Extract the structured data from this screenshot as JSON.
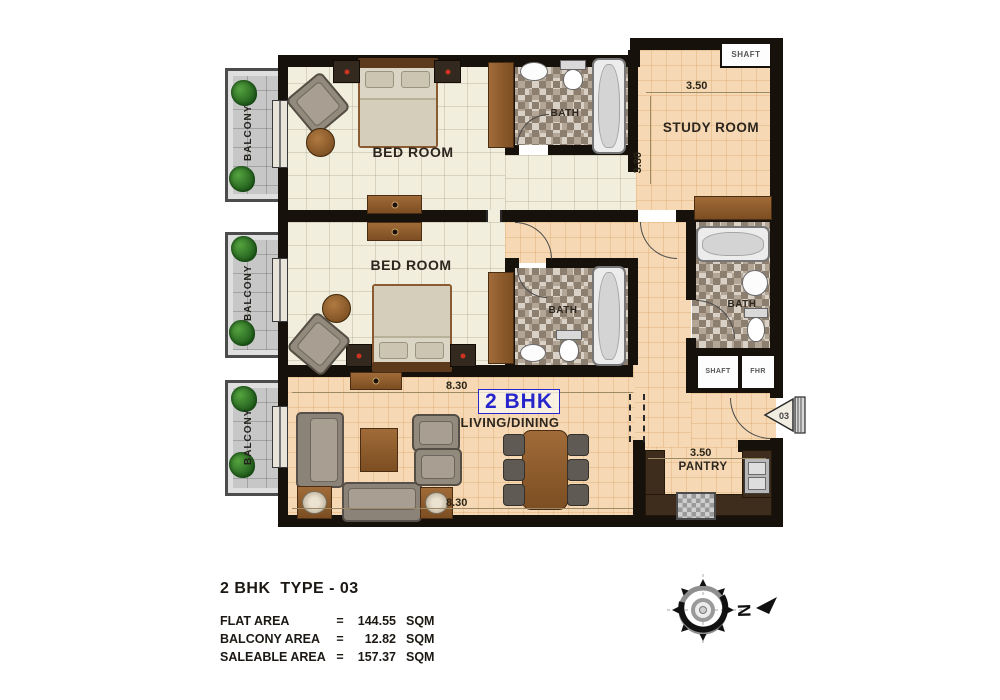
{
  "colors": {
    "wall": "#17110b",
    "bedroom_floor": "#f1eedd",
    "hall_floor": "#f6d9b4",
    "balcony_floor": "#c7c7c7",
    "wood": "#8a5a33",
    "counter_dark": "#3e2c1d",
    "accent_blue": "#2626cc"
  },
  "plan": {
    "rooms": {
      "bedroom1": "BED ROOM",
      "bedroom2": "BED ROOM",
      "study": "STUDY ROOM",
      "living": "LIVING/DINING",
      "unit": "2 BHK",
      "pantry": "PANTRY",
      "bath1": "BATH",
      "bath2": "BATH",
      "bath3": "BATH",
      "balcony1": "BALCONY",
      "balcony2": "BALCONY",
      "balcony3": "BALCONY",
      "shaft_top": "SHAFT",
      "shaft_mid": "SHAFT",
      "fhr": "FHR"
    },
    "dimensions": {
      "study_width": "3.50",
      "study_height": "3.80",
      "living_top": "8.30",
      "living_bottom": "8.30",
      "pantry_width": "3.50"
    },
    "entry_no": "03",
    "compass_north": "N"
  },
  "legend": {
    "title": "2 BHK  TYPE - 03",
    "rows": [
      {
        "label": "FLAT AREA",
        "eq": "=",
        "value": "144.55",
        "unit": "SQM"
      },
      {
        "label": "BALCONY AREA",
        "eq": "=",
        "value": "12.82",
        "unit": "SQM"
      },
      {
        "label": "SALEABLE AREA",
        "eq": "=",
        "value": "157.37",
        "unit": "SQM"
      }
    ]
  }
}
